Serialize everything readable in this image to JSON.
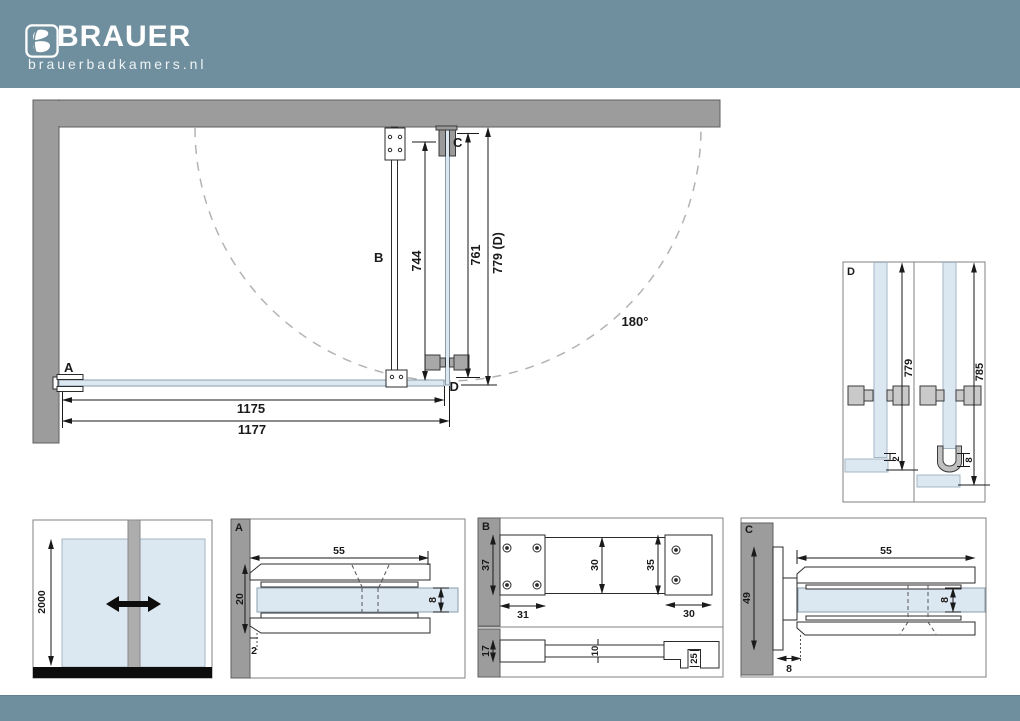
{
  "brand": {
    "name": "BRAUER",
    "site": "brauerbadkamers.nl"
  },
  "colors": {
    "header": "#6f8f9e",
    "wall": "#9c9c9c",
    "glass": "#dbe7f1",
    "floor": "#0d0d0d"
  },
  "plan": {
    "label_a": "A",
    "label_b": "B",
    "label_c": "C",
    "label_d": "D",
    "dim_bar": "744",
    "dim_door": "761",
    "dim_door_total": "779 (D)",
    "dim_glass_width": "1175",
    "dim_total_width": "1177",
    "swing_angle": "180°"
  },
  "detail_d": {
    "label": "D",
    "dim_left_height": "779",
    "dim_right_height": "785",
    "dim_gap": "2",
    "dim_seal": "8"
  },
  "elevation": {
    "dim_height": "2000"
  },
  "detail_a": {
    "label": "A",
    "dim_width": "55",
    "dim_height": "20",
    "dim_glass": "8",
    "dim_gap": "2"
  },
  "detail_b": {
    "label": "B",
    "dim_plate_h": "37",
    "dim_plate_w": "31",
    "dim_bar": "30",
    "dim_end_h": "35",
    "dim_end_w": "30",
    "dim_side_h": "17",
    "dim_side_bar": "10",
    "dim_clamp": "25"
  },
  "detail_c": {
    "label": "C",
    "dim_width": "55",
    "dim_hinge_h": "49",
    "dim_glass": "8",
    "dim_offset": "8"
  }
}
